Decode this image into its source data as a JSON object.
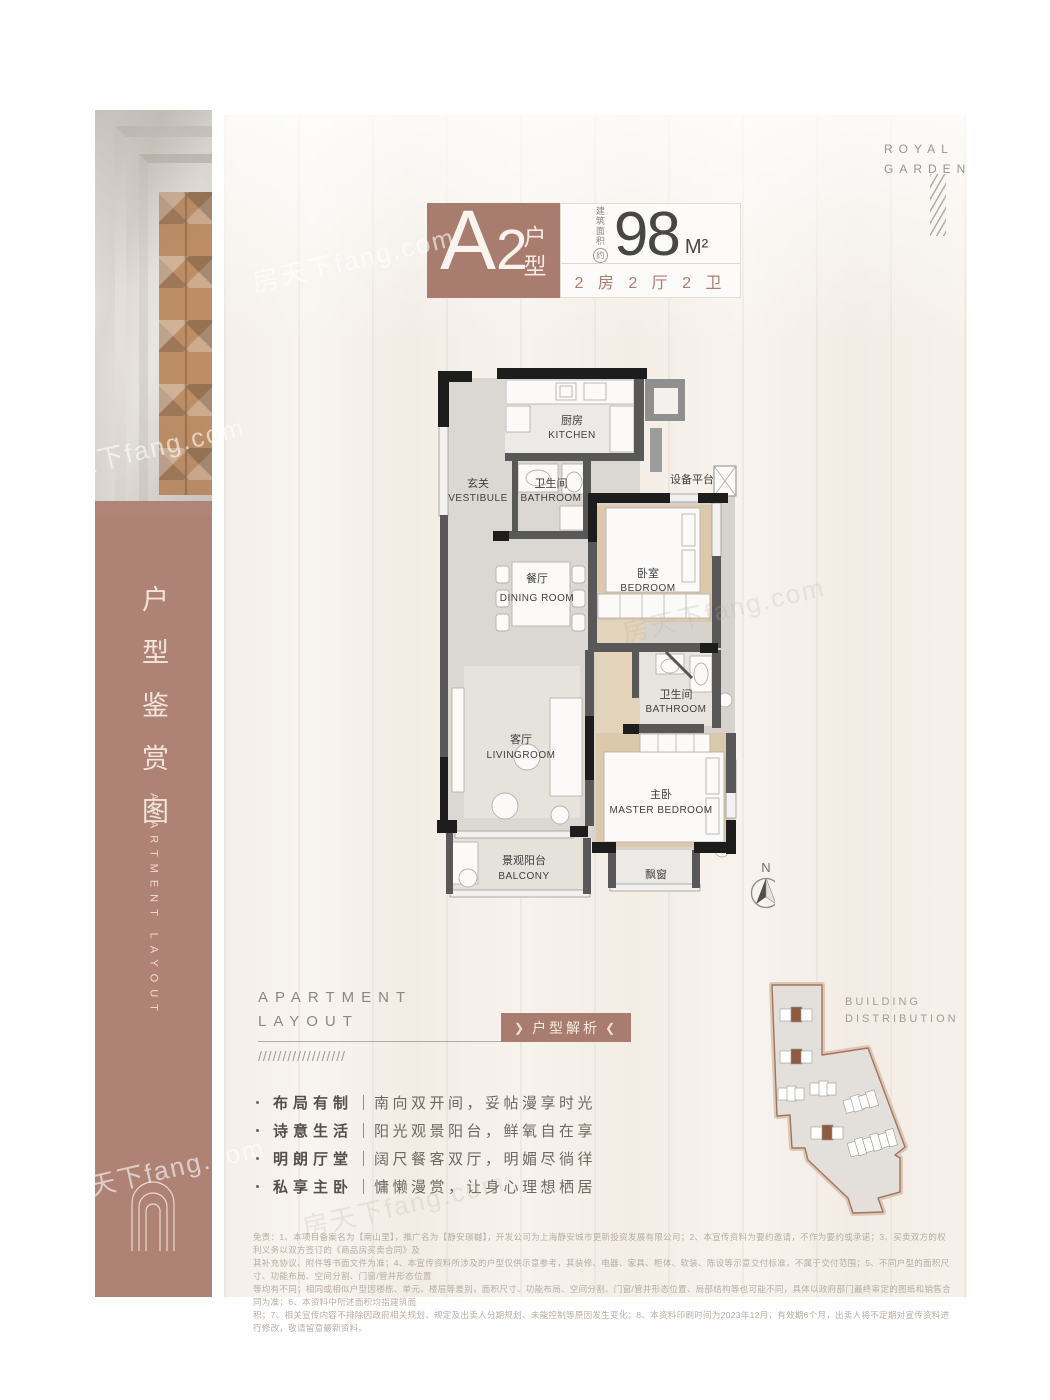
{
  "brand": {
    "line1": "ROYAL",
    "line2": "GARDEN"
  },
  "sidebar": {
    "title": "户型鉴赏图",
    "subtitle": "APARTMENT LAYOUT"
  },
  "unit_badge": {
    "code": "A",
    "code2": "2",
    "suffix": "户型",
    "area_label_chars": [
      "建",
      "筑",
      "面",
      "积"
    ],
    "approx": "约",
    "area_value": "98",
    "area_unit": "M²",
    "spec": "2 房 2 厅 2 卫"
  },
  "floorplan": {
    "rooms": {
      "kitchen": {
        "zh": "厨房",
        "en": "KITCHEN"
      },
      "vestibule": {
        "zh": "玄关",
        "en": "VESTIBULE"
      },
      "bathroom1": {
        "zh": "卫生间",
        "en": "BATHROOM"
      },
      "bedroom": {
        "zh": "卧室",
        "en": "BEDROOM"
      },
      "dining": {
        "zh": "餐厅",
        "en": "DINING ROOM"
      },
      "bathroom2": {
        "zh": "卫生间",
        "en": "BATHROOM"
      },
      "living": {
        "zh": "客厅",
        "en": "LIVINGROOM"
      },
      "master": {
        "zh": "主卧",
        "en": "MASTER BEDROOM"
      },
      "balcony": {
        "zh": "景观阳台",
        "en": "BALCONY"
      }
    },
    "equipment_label": "设备平台",
    "bay_window_label": "飘窗",
    "compass_label": "N"
  },
  "section": {
    "heading_line1": "APARTMENT",
    "heading_line2": "LAYOUT",
    "badge": "户型解析",
    "chevron_left": "❯",
    "chevron_right": "❮",
    "slashes": "//////////////////"
  },
  "features": [
    {
      "label": "布局有制",
      "desc": "南向双开间，妥帖漫享时光"
    },
    {
      "label": "诗意生活",
      "desc": "阳光观景阳台，鲜氧自在享"
    },
    {
      "label": "明朗厅堂",
      "desc": "阔尺餐客双厅，明媚尽徜徉"
    },
    {
      "label": "私享主卧",
      "desc": "慵懒漫赏，让身心理想栖居"
    }
  ],
  "building_distribution": {
    "title_line1": "BUILDING",
    "title_line2": "DISTRIBUTION"
  },
  "disclaimer": {
    "lines": [
      "免责：1、本项目备案名为【南山里】，推广名为【静安璟樾】，开发公司为上海静安城市更新投资发展有限公司；2、本宣传资料为要约邀请，不作为要约或承诺；3、买卖双方的权利义务以双方签订的《商品房买卖合同》及",
      "其补充协议、附件等书面文件为准；4、本宣传资料所涉及的户型仅供示意参考，其装修、电器、家具、柜体、软装、陈设等示意交付标准，不属于交付范围；5、不同户型的面积尺寸、功能布局、空间分割、门窗/管井形态位置",
      "等均有不同；相同或相似户型因楼栋、单元、楼层等差别，面积尺寸、功能布局、空间分割、门窗/管井形态位置、局部结构等也可能不同，具体以政府部门最终审定的图纸和销售合同为准；6、本资料中所述面积均指建筑面",
      "积；7、相关宣传内容不排除因政府相关规划、规定及出卖人分期规划、未能控制等原因发生变化；8、本资料印刷时间为2023年12月，有效期6个月，出卖人将不定期对宣传资料进行修改，敬请留意最新资料。"
    ]
  },
  "watermark": {
    "text": "房天下fang.com"
  },
  "colors": {
    "accent_mauve": "#ae8275",
    "badge_bg": "#a87c6e",
    "panel_cream": "#f4efe8",
    "ink": "#474745"
  }
}
